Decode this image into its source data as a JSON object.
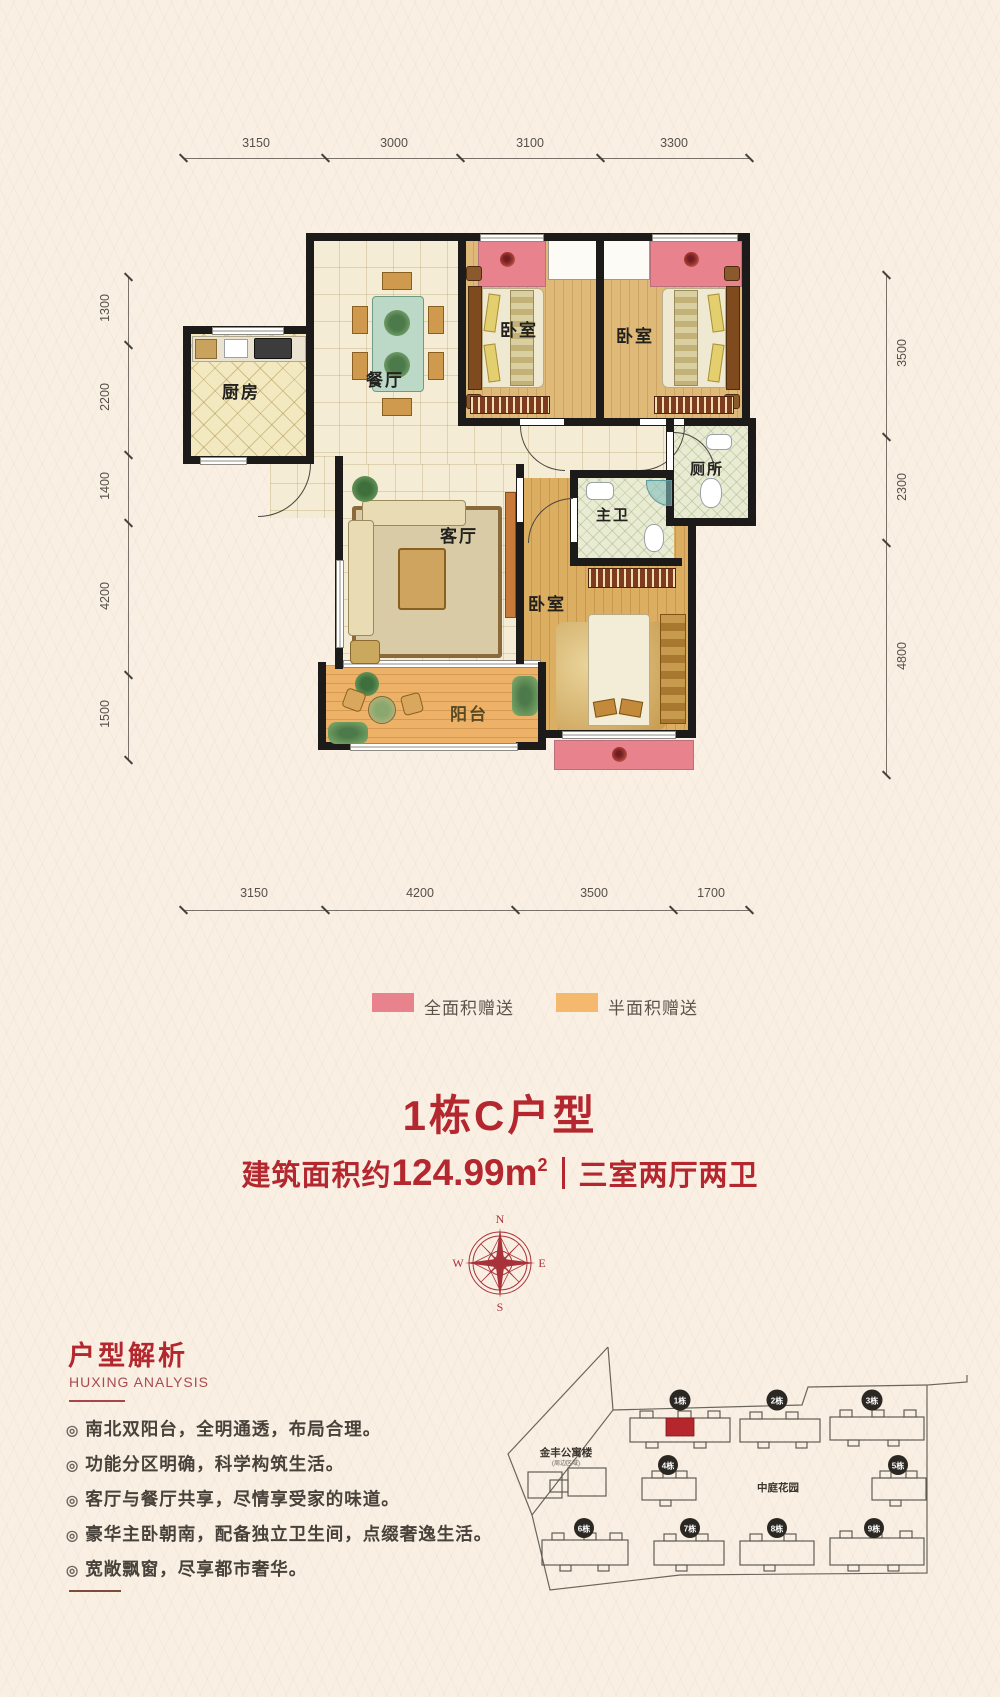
{
  "plan": {
    "dims_top": [
      "3150",
      "3000",
      "3100",
      "3300"
    ],
    "dims_bottom": [
      "3150",
      "4200",
      "3500",
      "1700"
    ],
    "dims_left": [
      "1300",
      "2200",
      "1400",
      "4200",
      "1500"
    ],
    "dims_right": [
      "3500",
      "2300",
      "4800"
    ],
    "rooms": {
      "kitchen": "厨房",
      "dining": "餐厅",
      "bedroom_top_left": "卧室",
      "bedroom_top_right": "卧室",
      "master_bedroom": "卧室",
      "living": "客厅",
      "master_bath": "主卫",
      "toilet": "厕所",
      "balcony": "阳台"
    }
  },
  "legend": {
    "full_area": "全面积赠送",
    "half_area": "半面积赠送",
    "full_color": "#e8828c",
    "half_color": "#f5b96e"
  },
  "title": {
    "main": "1栋C户型",
    "area_prefix": "建筑面积约",
    "area_value": "124.99m",
    "area_exp": "2",
    "layout": "三室两厅两卫"
  },
  "compass": {
    "n": "N",
    "e": "E",
    "s": "S",
    "w": "W"
  },
  "analysis": {
    "title": "户型解析",
    "subtitle": "HUXING ANALYSIS",
    "bullet_glyph": "◎",
    "bullets": [
      "南北双阳台，全明通透，布局合理。",
      "功能分区明确，科学构筑生活。",
      "客厅与餐厅共享，尽情享受家的味道。",
      "豪华主卧朝南，配备独立卫生间，点缀奢逸生活。",
      "宽敞飘窗，尽享都市奢华。"
    ]
  },
  "siteplan": {
    "buildings": [
      "1栋",
      "2栋",
      "3栋",
      "4栋",
      "5栋",
      "6栋",
      "7栋",
      "8栋",
      "9栋"
    ],
    "apartment_label": "金丰公寓楼",
    "apartment_note": "(周边区域)",
    "garden_label": "中庭花园",
    "highlight_color": "#b5272d"
  }
}
